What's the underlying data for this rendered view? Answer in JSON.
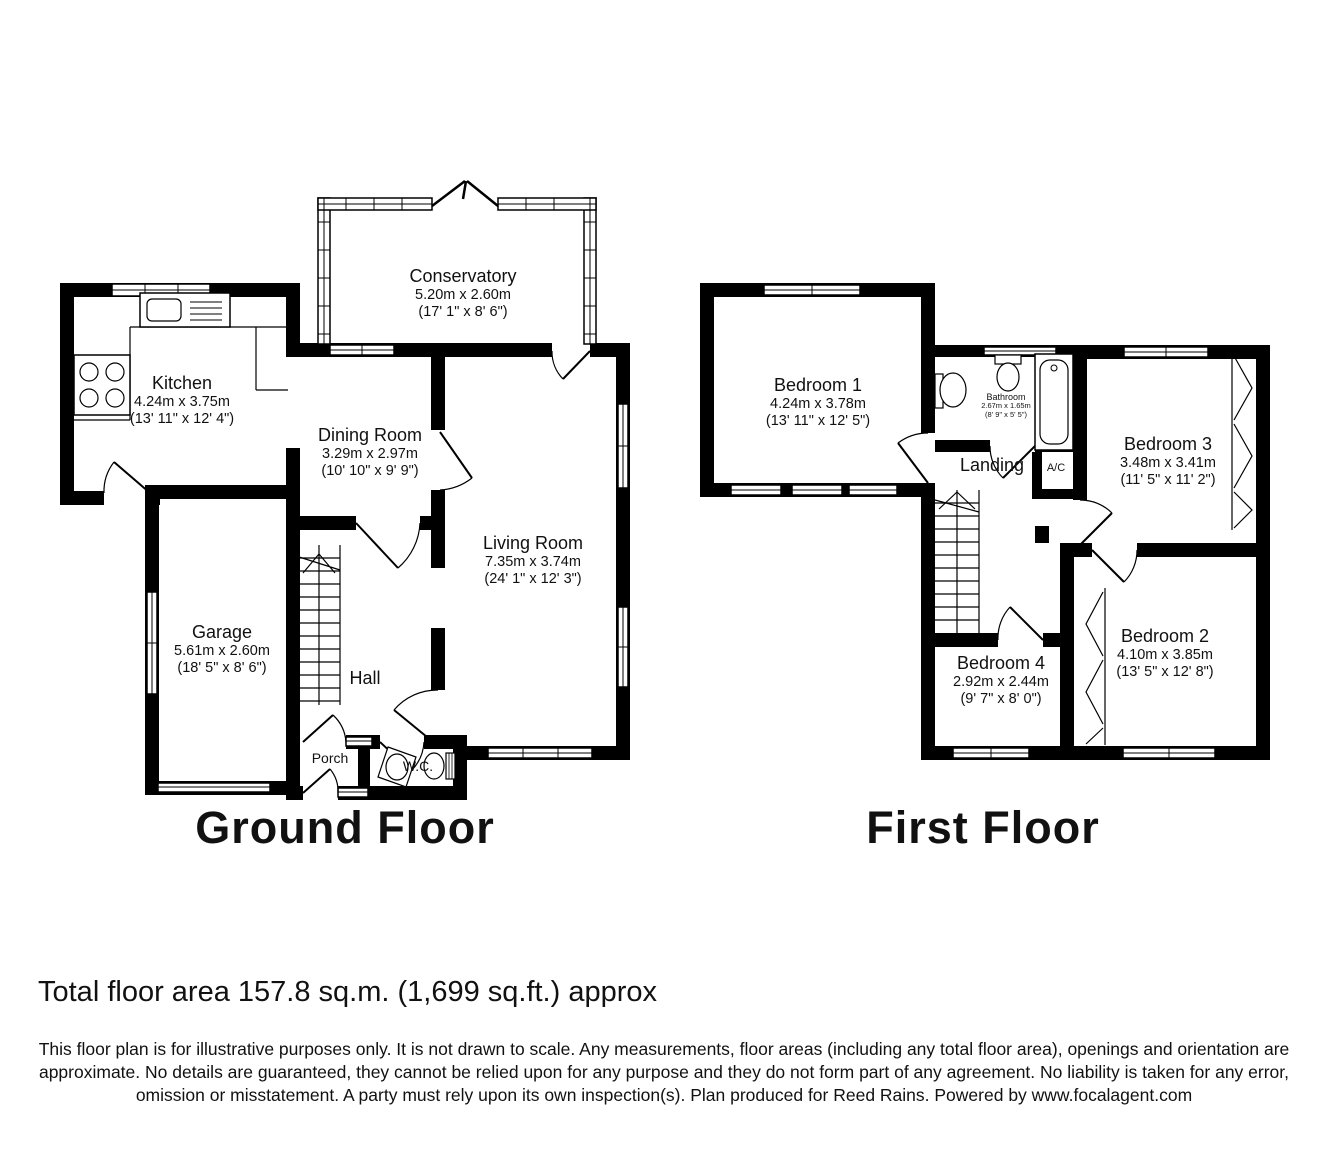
{
  "floors": [
    {
      "title": "Ground Floor",
      "rooms": [
        {
          "name": "Conservatory",
          "metric": "5.20m x 2.60m",
          "imperial": "(17' 1\" x 8' 6\")"
        },
        {
          "name": "Kitchen",
          "metric": "4.24m x 3.75m",
          "imperial": "(13' 11\" x 12' 4\")"
        },
        {
          "name": "Dining Room",
          "metric": "3.29m x 2.97m",
          "imperial": "(10' 10\" x 9' 9\")"
        },
        {
          "name": "Living Room",
          "metric": "7.35m x 3.74m",
          "imperial": "(24' 1\" x 12' 3\")"
        },
        {
          "name": "Garage",
          "metric": "5.61m x 2.60m",
          "imperial": "(18' 5\" x 8' 6\")"
        },
        {
          "name": "Hall"
        },
        {
          "name": "Porch"
        },
        {
          "name": "W.C."
        }
      ]
    },
    {
      "title": "First Floor",
      "rooms": [
        {
          "name": "Bedroom 1",
          "metric": "4.24m x 3.78m",
          "imperial": "(13' 11\" x 12' 5\")"
        },
        {
          "name": "Bathroom",
          "metric": "2.67m x 1.65m",
          "imperial": "(8' 9\" x 5' 5\")"
        },
        {
          "name": "Landing"
        },
        {
          "name": "A/C"
        },
        {
          "name": "Bedroom 3",
          "metric": "3.48m x 3.41m",
          "imperial": "(11' 5\" x 11' 2\")"
        },
        {
          "name": "Bedroom 2",
          "metric": "4.10m x 3.85m",
          "imperial": "(13' 5\" x 12' 8\")"
        },
        {
          "name": "Bedroom 4",
          "metric": "2.92m x 2.44m",
          "imperial": "(9' 7\" x 8' 0\")"
        }
      ]
    }
  ],
  "footer": {
    "total_area": "Total floor area 157.8 sq.m. (1,699 sq.ft.) approx",
    "disclaimer": "This floor plan is for illustrative purposes only. It is not drawn to scale. Any measurements, floor areas (including any total floor area), openings and orientation are approximate. No details are guaranteed, they cannot be relied upon for any purpose and they do not form part of any agreement. No liability is taken for any error, omission or misstatement. A party must rely upon its own inspection(s). Plan produced for Reed Rains. Powered by www.focalagent.com"
  }
}
